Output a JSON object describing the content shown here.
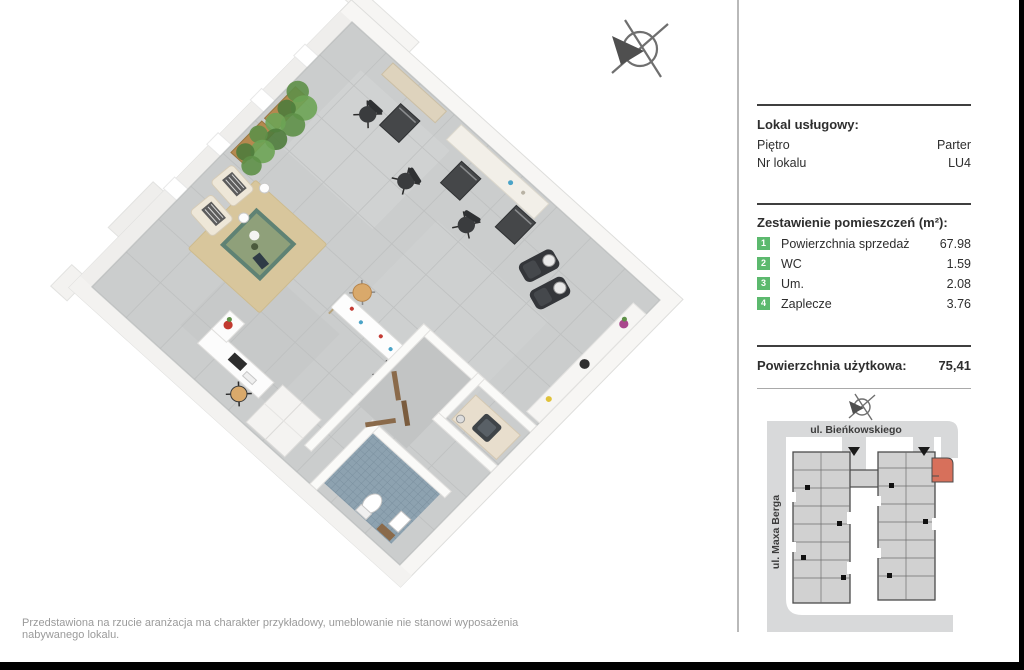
{
  "panel": {
    "unit_header": {
      "title": "Lokal usługowy:",
      "rows": [
        {
          "label": "Piętro",
          "value": "Parter"
        },
        {
          "label": "Nr lokalu",
          "value": "LU4"
        }
      ]
    },
    "rooms_section": {
      "title": "Zestawienie pomieszczeń (m²):",
      "rooms": [
        {
          "num": "1",
          "label": "Powierzchnia sprzedaż",
          "value": "67.98"
        },
        {
          "num": "2",
          "label": "WC",
          "value": "1.59"
        },
        {
          "num": "3",
          "label": "Um.",
          "value": "2.08"
        },
        {
          "num": "4",
          "label": "Zaplecze",
          "value": "3.76"
        }
      ]
    },
    "total": {
      "label": "Powierzchnia użytkowa:",
      "value": "75,41"
    }
  },
  "site_map": {
    "street_top": "ul. Bieńkowskiego",
    "street_left": "ul. Maxa Berga",
    "highlight_color": "#d7705b",
    "street_color": "#d8d9da",
    "building_fill": "#d1d1d1",
    "building_outline": "#4b4b4b"
  },
  "floor_plan": {
    "room_numbers_color": "#5cb96e",
    "floor_color": "#cbcdcd",
    "wc_floor_color": "#8da2b0"
  },
  "footer": {
    "disclaimer": "Przedstawiona na rzucie aranżacja ma charakter przykładowy, umeblowanie nie stanowi wyposażenia nabywanego lokalu."
  }
}
